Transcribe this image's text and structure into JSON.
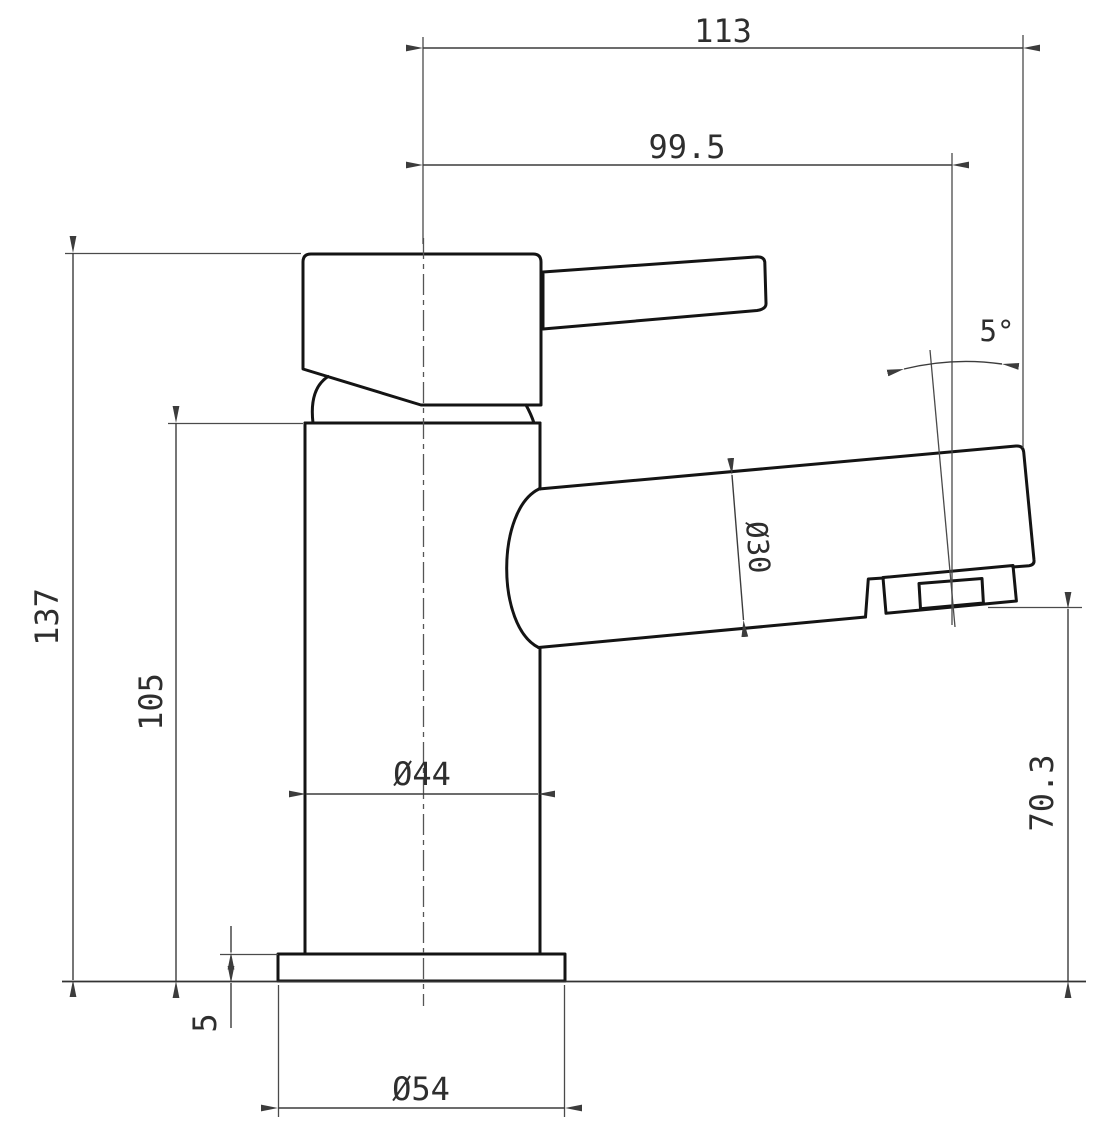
{
  "drawing": {
    "subject": "basin-mixer-tap-side-elevation",
    "labels": {
      "overall_width": "113",
      "spout_reach": "99.5",
      "spout_angle": "5°",
      "overall_height": "137",
      "body_height": "105",
      "body_diameter": "Ø44",
      "spout_tube_diameter": "Ø30",
      "outlet_height": "70.3",
      "base_plate_thickness": "5",
      "base_diameter": "Ø54"
    },
    "colors": {
      "outline": "#141414",
      "dimension_line": "#3c3c3c",
      "text": "#2e2e2e",
      "background": "#ffffff"
    }
  }
}
